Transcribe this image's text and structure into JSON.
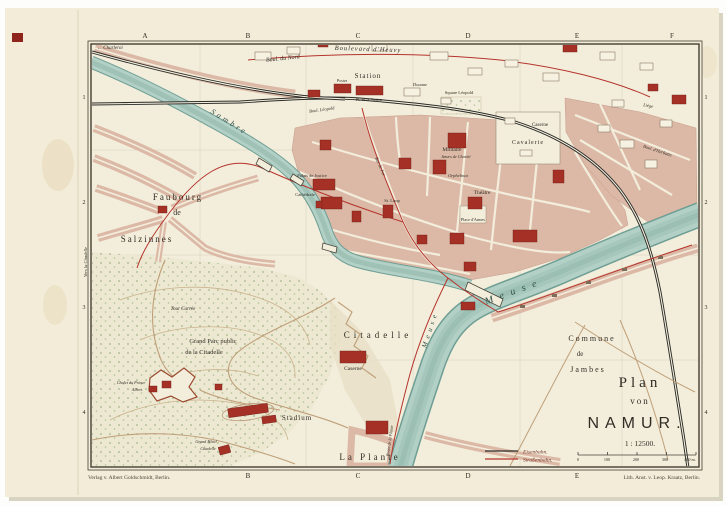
{
  "colors": {
    "paper": "#f2ecd8",
    "map_ground": "#f3eedc",
    "block_pink": "#dcb9a6",
    "building_red": "#a53026",
    "river_fill": "#b2d0c6",
    "river_edge": "#6f9e94",
    "railway_black": "#2b2b28",
    "tram_red": "#b5342c",
    "park_dot_green": "#96ad7c",
    "frame_ink": "#433d30",
    "label_ink": "#302c24"
  },
  "grid": {
    "top_letters": [
      "A",
      "B",
      "C",
      "D",
      "E",
      "F"
    ],
    "bottom_letters": [
      "B",
      "C",
      "D",
      "E"
    ],
    "left_numbers": [
      "1",
      "2",
      "3",
      "4"
    ],
    "right_numbers": [
      "1",
      "2",
      "3",
      "4"
    ]
  },
  "title_block": {
    "plan": "Plan",
    "von": "von",
    "namur": "NAMUR.",
    "scale": "1 : 12500.",
    "scale_ticks": [
      "0",
      "100",
      "200",
      "300",
      "400 m."
    ]
  },
  "legend": {
    "eisenbahn": "Eisenbahn.",
    "strassenbahn": "Straßenbahn."
  },
  "imprint": {
    "publisher": "Verlag v. Albert Goldschmidt, Berlin.",
    "lithographer": "Lith. Anst. v. Leop. Kraatz, Berlin."
  },
  "labels": {
    "charleroi": "← Charleroi",
    "boul_du_nord": "Boul. du Nord",
    "boulevard_heuvy": "Boulevard d'Heuvy",
    "prison": "Prison",
    "station": "Station",
    "postes": "Postes",
    "place_station": "Pl. de la Station",
    "douane": "Douane",
    "square_leopold": "Square Léopold",
    "boul_leopold": "Boul. Léopold",
    "sambre": "Sambre",
    "faubourg": "Faubourg",
    "faubourg_de": "de",
    "salzinnes": "Salzinnes",
    "vers_citadelle": "Vers la Citadelle",
    "caserne_ne": "Caserne",
    "cavalerie": "Cavalerie",
    "militaire": "Militaire",
    "soeurs_charite": "Sœurs de Charité",
    "orphelinat": "Orphelinat",
    "palais_justice": "Palais de Justice",
    "cathedrale": "Cathédrale",
    "st_loup": "St. Loup",
    "theatre": "Théâtre",
    "place_armes": "Place d'Armes",
    "rue_de_fer": "Rue de Fer",
    "herbatte": "Boul. d'Herbatte",
    "liege": "Liège",
    "meuse_1": "Meuse",
    "meuse_2": "Meuse",
    "commune": "Commune",
    "commune_de": "de",
    "jambes": "Jambes",
    "citadelle": "Citadelle",
    "caserne_citadelle": "Caserne",
    "grand_parc_1": "Grand Parc public",
    "grand_parc_2": "de la Citadelle",
    "tour_carree": "Tour Carrée",
    "chalet_1": "Chalet du Prince",
    "chalet_2": "Albert",
    "stadium": "Stadium",
    "la_plante": "La Plante",
    "grand_hotel_1": "Grand Hôtel",
    "grand_hotel_2": "Citadelle",
    "route_plante": "Route de la Plante"
  }
}
